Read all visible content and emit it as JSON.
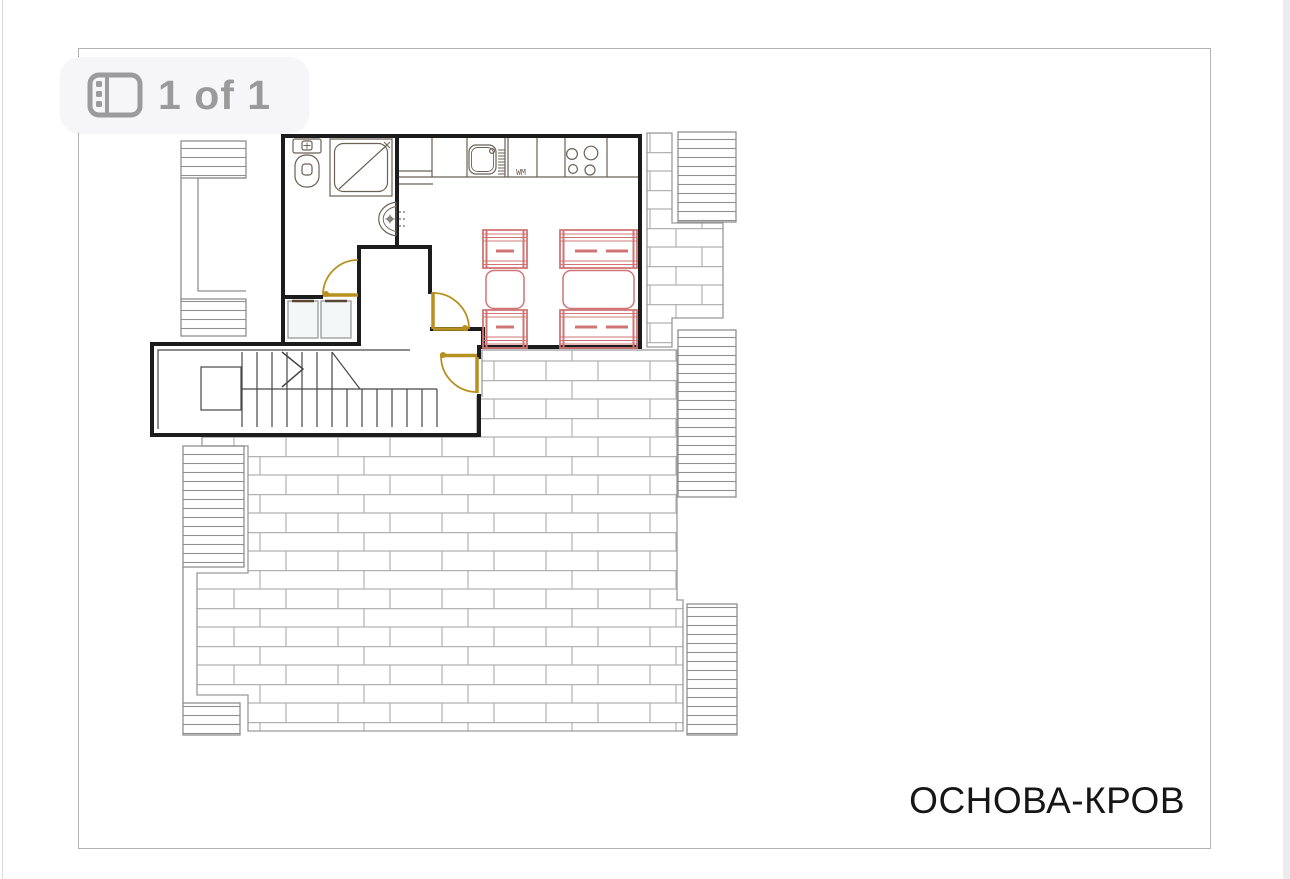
{
  "viewer": {
    "pager": {
      "label": "1 of 1",
      "icon": "pages-panel-icon"
    }
  },
  "plan": {
    "title": "ОСНОВА-КРОВ",
    "wm_label": "WM",
    "colors": {
      "wall": "#1c1c1c",
      "fixture": "#6a6157",
      "furniture": "#d07474",
      "door": "#b8901f",
      "brick_line": "#b2b2b2",
      "stripe_line": "#8f8f8f",
      "badge_text": "#9a9a9a",
      "wardrobe_fill": "#f3f7f7",
      "wardrobe_handle": "#5a4733"
    }
  }
}
